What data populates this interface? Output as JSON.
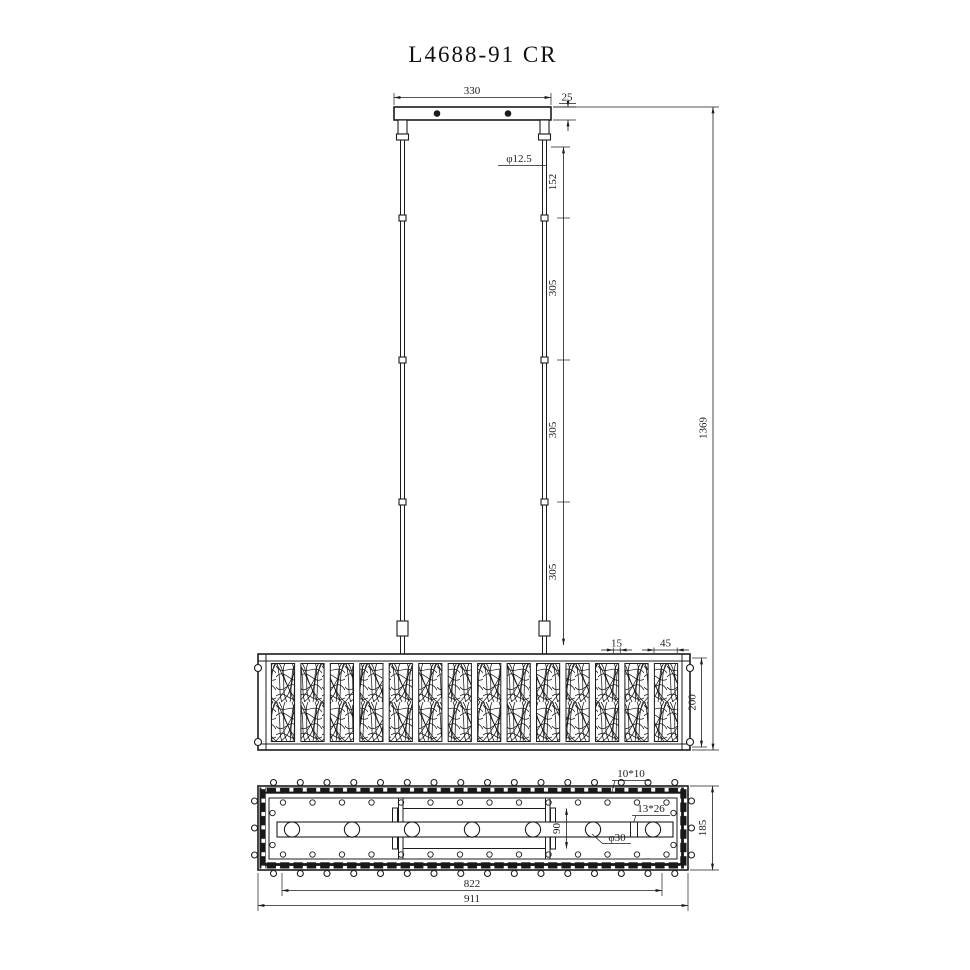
{
  "title": "L4688-91 CR",
  "colors": {
    "line": "#1c1c1c",
    "background": "#ffffff"
  },
  "front_view": {
    "dims": {
      "canopy_width": "330",
      "canopy_thickness": "25",
      "rod_diameter": "φ12.5",
      "rod_segments": [
        "152",
        "305",
        "305",
        "305"
      ],
      "total_height": "1369",
      "panel_gap": "15",
      "panel_width": "45",
      "shade_height": "200"
    }
  },
  "plan_view": {
    "dims": {
      "bead_size": "10*10",
      "crystal_size": "13*26",
      "channel_width": "90",
      "holder_diameter": "φ30",
      "body_depth": "185",
      "inner_length": "822",
      "overall_length": "911"
    }
  }
}
